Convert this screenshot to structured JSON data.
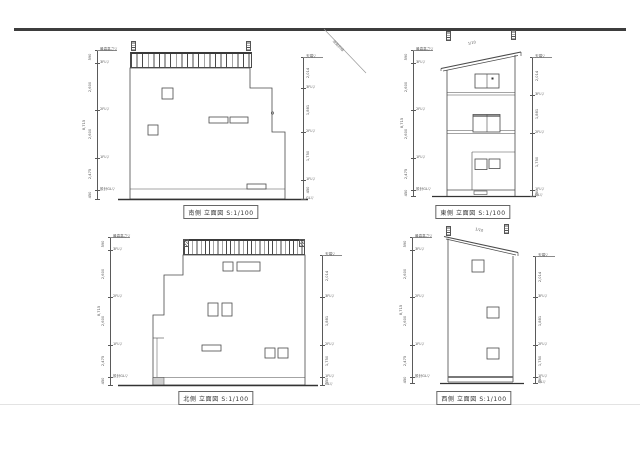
{
  "titles": {
    "south": "南側 立面図 S:1/100",
    "east": "東側 立面図 S:1/100",
    "north": "北側 立面図 S:1/100",
    "west": "西側 立面図 S:1/100"
  },
  "annotations": {
    "road_slant": "道路斜線",
    "roof_slope": "1/10"
  },
  "left_chain": {
    "levels": [
      "最高高さ▽",
      "3FL▽",
      "2FL▽",
      "1FL▽",
      "設計GL▽"
    ],
    "dims": [
      "590",
      "2,600",
      "2,600",
      "2,475",
      "450"
    ],
    "overall": "8,715"
  },
  "right_chain": {
    "levels": [
      "天端▽",
      "3FL▽",
      "2FL▽",
      "1FL▽",
      "GL▽"
    ],
    "dims": [
      "2,014",
      "1,881",
      "1,750",
      "450"
    ]
  },
  "colors": {
    "line": "#4a4a4a",
    "text": "#555555",
    "rule": "#3d3d3d",
    "background": "#ffffff"
  }
}
